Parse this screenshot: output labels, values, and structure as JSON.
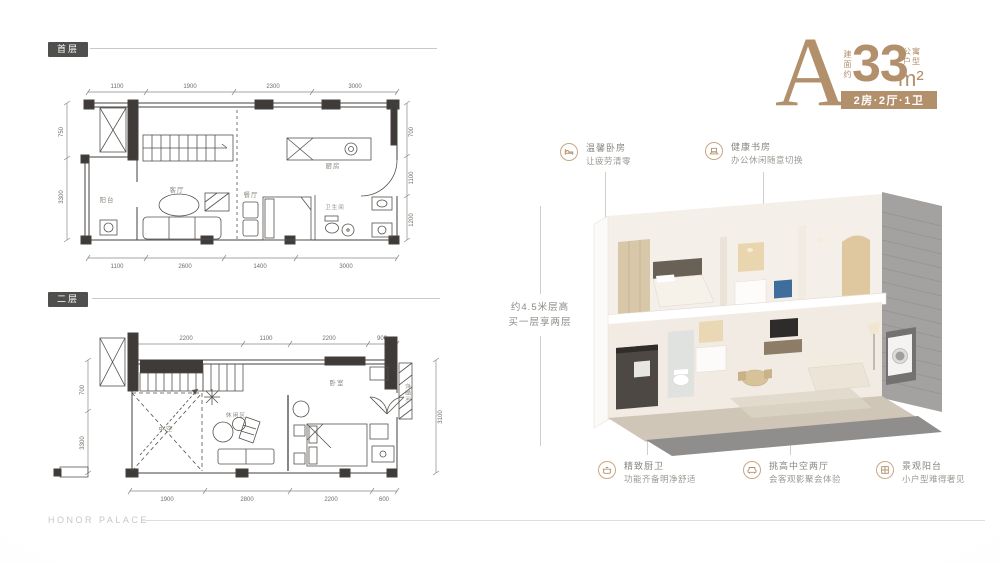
{
  "header": {
    "type_letter": "A",
    "area_prefix": "建面约",
    "area_value": "33",
    "area_unit": "m²",
    "category_top": "公寓",
    "category_bottom": "户型",
    "layout_badge": "2房·2厅·1卫"
  },
  "height_note": {
    "line1": "约4.5米层高",
    "line2": "买一层享两层"
  },
  "floor1": {
    "badge": "首层",
    "labels": {
      "balcony": "阳台",
      "living": "客厅",
      "dining": "餐厅",
      "kitchen": "厨房",
      "bath": "卫生间"
    },
    "dims_top": [
      "1100",
      "1900",
      "2300",
      "3000"
    ],
    "dims_bottom": [
      "1100",
      "2600",
      "1400",
      "3000"
    ],
    "dims_right": [
      "700",
      "1100",
      "1200"
    ],
    "dims_left": [
      "750",
      "3300"
    ]
  },
  "floor2": {
    "badge": "二层",
    "labels": {
      "void": "中空",
      "leisure": "休闲区",
      "bedroom": "卧室",
      "closet": "衣帽间"
    },
    "dims_top": [
      "2200",
      "1100",
      "2200",
      "900"
    ],
    "dims_bottom": [
      "1900",
      "2800",
      "2200",
      "600"
    ],
    "dims_right": [
      "3100"
    ],
    "dims_left": [
      "700",
      "3300"
    ]
  },
  "callouts": [
    {
      "icon": "bed-icon",
      "line1": "温馨卧房",
      "line2": "让疲劳清零"
    },
    {
      "icon": "study-icon",
      "line1": "健康书房",
      "line2": "办公休闲随意切换"
    },
    {
      "icon": "kitchen-icon",
      "line1": "精致厨卫",
      "line2": "功能齐备明净舒适"
    },
    {
      "icon": "sofa-icon",
      "line1": "挑高中空两厅",
      "line2": "会客观影聚会体验"
    },
    {
      "icon": "balcony-icon",
      "line1": "景观阳台",
      "line2": "小户型难得奢见"
    }
  ],
  "footer": {
    "watermark": "HONOR PALACE"
  },
  "colors": {
    "accent": "#b2906c",
    "badge_dark": "#4f4f4d"
  }
}
